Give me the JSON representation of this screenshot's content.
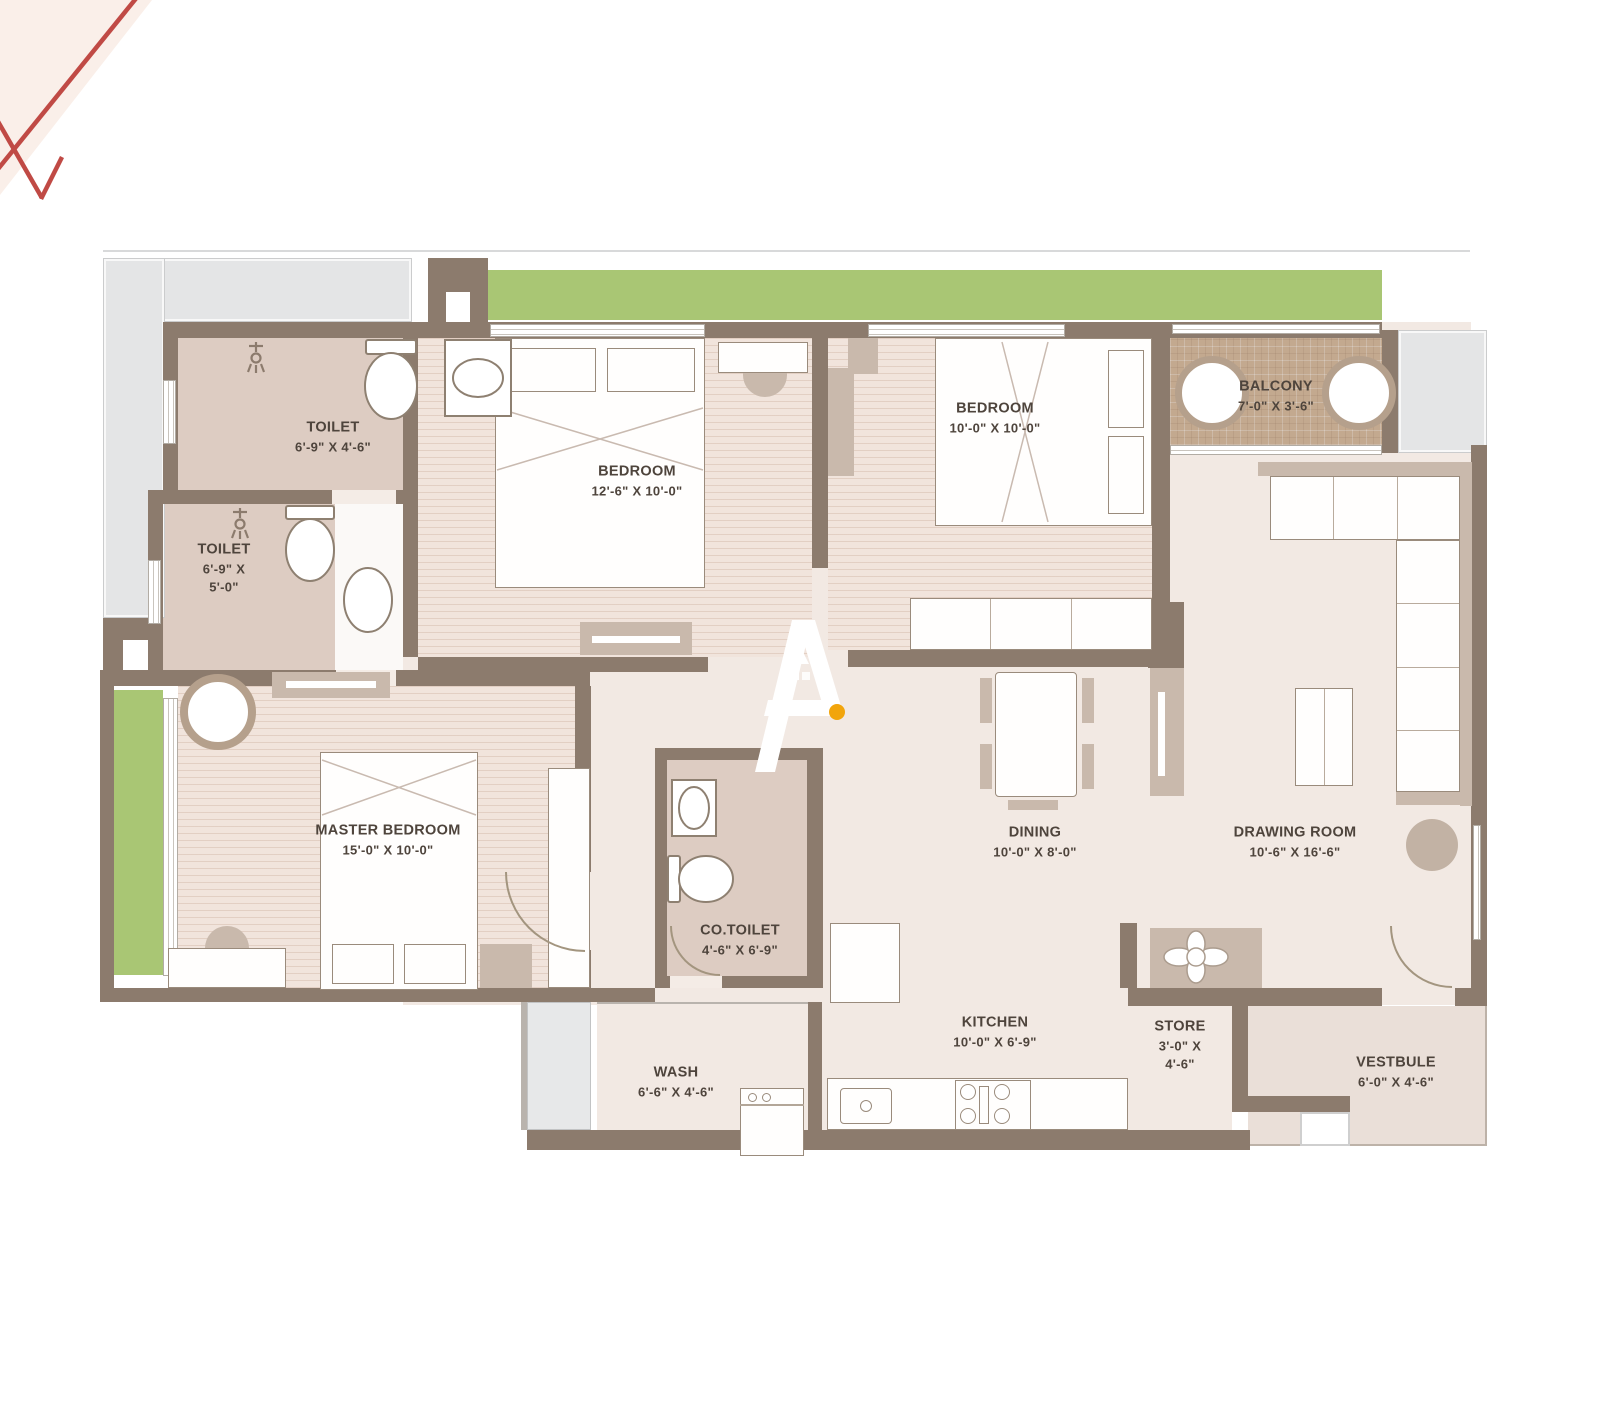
{
  "plan_title": "2BHK + Master Bedroom Apartment Floor Plan",
  "rooms": [
    {
      "id": "toilet-1",
      "name": "TOILET",
      "dims": "6'-9\" X 4'-6\""
    },
    {
      "id": "toilet-2",
      "name": "TOILET",
      "dims": "6'-9\" X",
      "dims2": "5'-0\""
    },
    {
      "id": "bedroom-1",
      "name": "BEDROOM",
      "dims": "12'-6\" X 10'-0\""
    },
    {
      "id": "bedroom-2",
      "name": "BEDROOM",
      "dims": "10'-0\" X 10'-0\""
    },
    {
      "id": "balcony",
      "name": "BALCONY",
      "dims": "7'-0\" X 3'-6\""
    },
    {
      "id": "master-bedroom",
      "name": "MASTER BEDROOM",
      "dims": "15'-0\" X 10'-0\""
    },
    {
      "id": "co-toilet",
      "name": "CO.TOILET",
      "dims": "4'-6\" X 6'-9\""
    },
    {
      "id": "dining",
      "name": "DINING",
      "dims": "10'-0\" X 8'-0\""
    },
    {
      "id": "drawing-room",
      "name": "DRAWING ROOM",
      "dims": "10'-6\" X 16'-6\""
    },
    {
      "id": "wash",
      "name": "WASH",
      "dims": "6'-6\" X 4'-6\""
    },
    {
      "id": "kitchen",
      "name": "KITCHEN",
      "dims": "10'-0\" X 6'-9\""
    },
    {
      "id": "store",
      "name": "STORE",
      "dims": "3'-0\" X",
      "dims2": "4'-6\""
    },
    {
      "id": "vestibule",
      "name": "VESTBULE",
      "dims": "6'-0\" X 4'-6\""
    }
  ],
  "colors": {
    "wall": "#8c7b6d",
    "floor": "#f2e9e3",
    "bedroom_floor": "#f1e4dc",
    "toilet_floor": "#ddccc2",
    "balcony_tile": "#c3a98f",
    "lawn_green": "#a9c674",
    "terrace_gray": "#e4e5e6",
    "vestibule_floor": "#eadfd8",
    "furniture_accent": "#c9b9ac",
    "label_text": "#4e443c",
    "corner_pink": "#faefe9",
    "corner_red": "#c04a45",
    "logo_dot_yellow": "#f2a50c"
  }
}
